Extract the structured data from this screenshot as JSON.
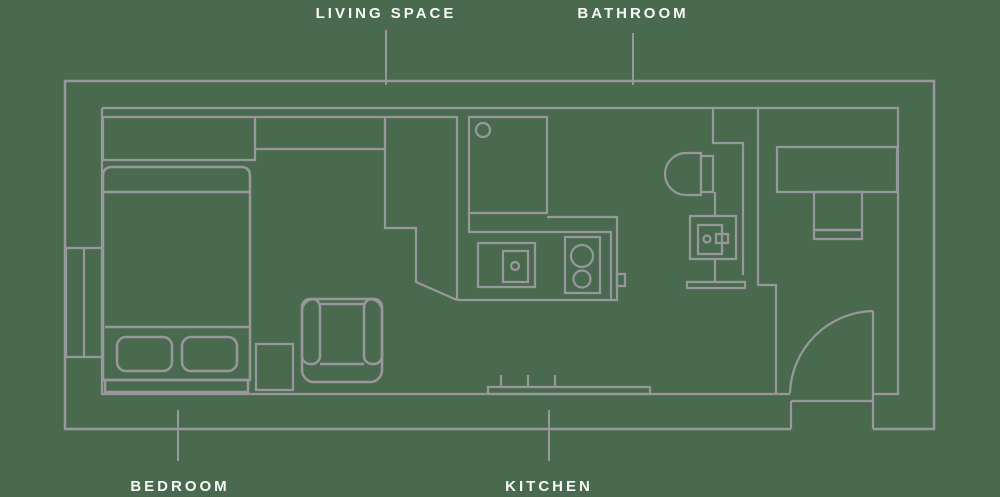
{
  "labels": {
    "living_space": {
      "text": "LIVING SPACE"
    },
    "bathroom": {
      "text": "BATHROOM"
    },
    "bedroom": {
      "text": "BEDROOM"
    },
    "kitchen": {
      "text": "KITCHEN"
    }
  },
  "rooms": {
    "bedroom_fixtures": [
      "bed",
      "pillows",
      "headboard",
      "wardrobe",
      "desk",
      "window",
      "side-table",
      "armchair"
    ],
    "kitchen_fixtures": [
      "upper-cabinet",
      "tall-cabinet",
      "counter",
      "sink",
      "stove",
      "bench"
    ],
    "bathroom_fixtures": [
      "toilet",
      "vanity-sink",
      "threshold"
    ],
    "living_fixtures": [
      "wall-desk",
      "seat-unit",
      "entry-door"
    ]
  },
  "colors": {
    "background": "#4a6a4f",
    "line": "#98979b",
    "label_text": "#f7f7f7"
  }
}
